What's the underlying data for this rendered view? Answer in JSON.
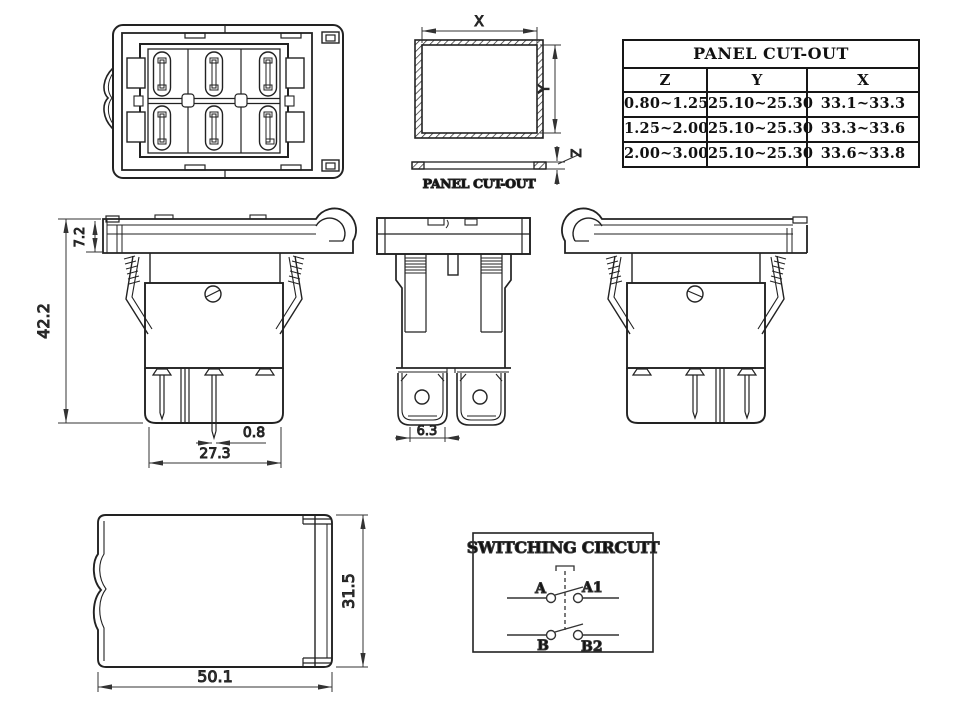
{
  "cutout_table": {
    "title": "PANEL CUT-OUT",
    "columns": [
      "Z",
      "Y",
      "X"
    ],
    "rows": [
      [
        "0.80~1.25",
        "25.10~25.30",
        "33.1~33.3"
      ],
      [
        "1.25~2.00",
        "25.10~25.30",
        "33.3~33.6"
      ],
      [
        "2.00~3.00",
        "25.10~25.30",
        "33.6~33.8"
      ]
    ]
  },
  "panel_cutout_diagram": {
    "x_label": "X",
    "y_label": "Y",
    "z_label": "Z",
    "caption": "PANEL CUT-OUT"
  },
  "dimensions": {
    "bezel_height": "7.2",
    "total_height": "42.2",
    "terminal_thickness": "0.8",
    "body_width": "27.3",
    "terminal_width": "6.3",
    "frame_length": "50.1",
    "frame_depth": "31.5"
  },
  "switching_circuit": {
    "title": "SWITCHING CIRCUIT",
    "terminals": {
      "a": "A",
      "a1": "A1",
      "b": "B",
      "b2": "B2"
    }
  }
}
